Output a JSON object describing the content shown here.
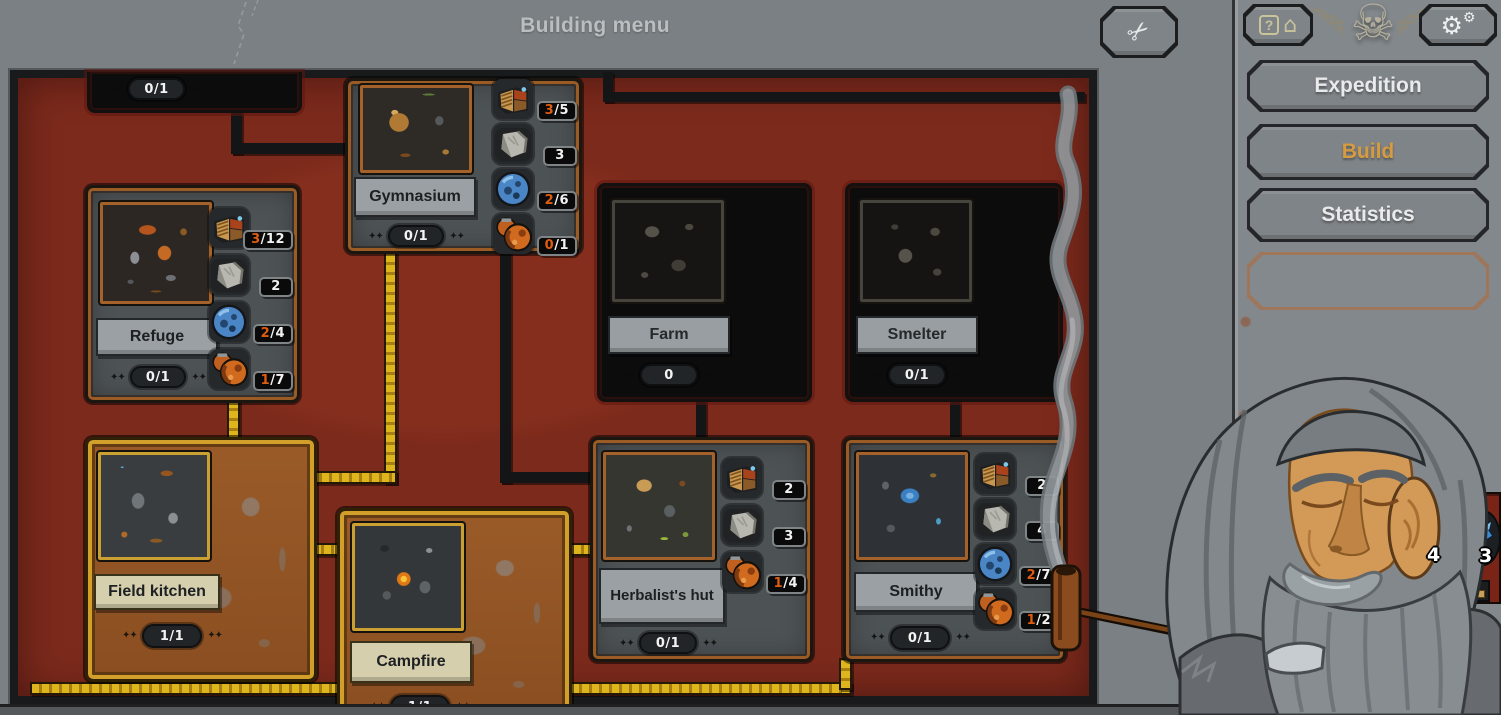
{
  "window": {
    "title": "Building menu"
  },
  "icons": {
    "close": "✂",
    "help_q": "?",
    "help_house": "⌂",
    "settings_main": "⚙",
    "settings_small": "⚙",
    "emblem": "☠"
  },
  "sidebar": {
    "buttons": [
      {
        "id": "expedition",
        "label": "Expedition"
      },
      {
        "id": "build",
        "label": "Build"
      },
      {
        "id": "statistics",
        "label": "Statistics"
      },
      {
        "id": "empty",
        "label": ""
      }
    ]
  },
  "hud": {
    "slot_a_count": "4",
    "slot_b_count": "3"
  },
  "cards": {
    "top_partial": {
      "count": "0/1"
    },
    "refuge": {
      "name": "Refuge",
      "count": "0/1",
      "costs": [
        {
          "icon": "wood",
          "hl": "3",
          "rest": "/12"
        },
        {
          "icon": "stone",
          "hl": "",
          "rest": "2"
        },
        {
          "icon": "ore",
          "hl": "2",
          "rest": "/4"
        },
        {
          "icon": "pot",
          "hl": "1",
          "rest": "/7"
        }
      ]
    },
    "gymnasium": {
      "name": "Gymnasium",
      "count": "0/1",
      "costs": [
        {
          "icon": "wood",
          "hl": "3",
          "rest": "/5"
        },
        {
          "icon": "stone",
          "hl": "",
          "rest": "3"
        },
        {
          "icon": "ore",
          "hl": "2",
          "rest": "/6"
        },
        {
          "icon": "pot",
          "hl": "0",
          "rest": "/1"
        }
      ]
    },
    "farm": {
      "name": "Farm",
      "count": "0"
    },
    "smelter": {
      "name": "Smelter",
      "count": "0/1"
    },
    "field_kitchen": {
      "name": "Field kitchen",
      "count": "1/1"
    },
    "campfire": {
      "name": "Campfire",
      "count": "1/1"
    },
    "herbalist": {
      "name": "Herbalist's hut",
      "count": "0/1",
      "costs": [
        {
          "icon": "wood",
          "hl": "",
          "rest": "2"
        },
        {
          "icon": "stone",
          "hl": "",
          "rest": "3"
        },
        {
          "icon": "pot",
          "hl": "1",
          "rest": "/4"
        }
      ]
    },
    "smithy": {
      "name": "Smithy",
      "count": "0/1",
      "costs": [
        {
          "icon": "wood",
          "hl": "",
          "rest": "2"
        },
        {
          "icon": "stone",
          "hl": "",
          "rest": "4"
        },
        {
          "icon": "ore",
          "hl": "2",
          "rest": "/7"
        },
        {
          "icon": "pot",
          "hl": "1",
          "rest": "/2"
        }
      ]
    }
  },
  "colors": {
    "accent_gold": "#d79b3f",
    "cost_highlight": "#e05c10",
    "panel_maroon": "#7c2a1c",
    "link_built_yellow": "#dfb51d"
  }
}
